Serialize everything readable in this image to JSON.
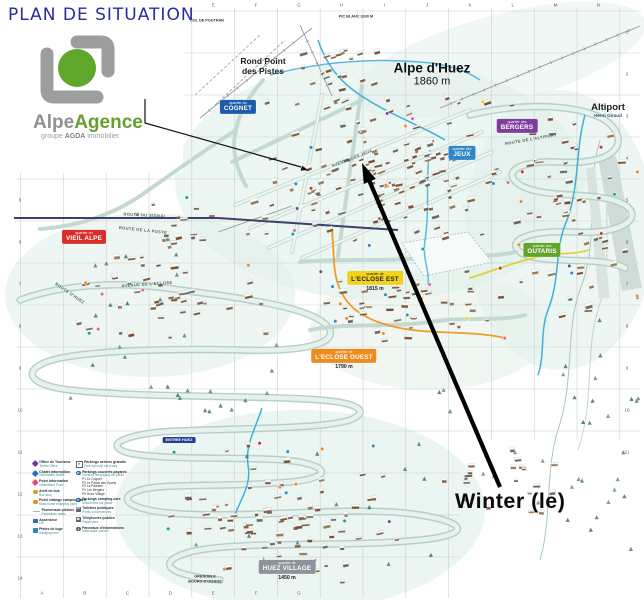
{
  "page": {
    "title": "PLAN DE SITUATION"
  },
  "logo": {
    "brand_gray": "Alpe",
    "brand_green": "Agence",
    "tagline_pre": "groupe",
    "tagline_bold": "AGDA",
    "tagline_post": "immobilier",
    "colors": {
      "mark_gray": "#9c9e9d",
      "mark_green": "#5fa62b"
    }
  },
  "annotation": {
    "label": "Winter (le)",
    "color": "#000000"
  },
  "resort": {
    "name": "Alpe d'Huez",
    "altitude": "1860 m"
  },
  "map": {
    "towns": [
      {
        "id": "rond-point",
        "lines": [
          "Rond Point",
          "des Pistes"
        ]
      },
      {
        "id": "altiport",
        "lines": [
          "Altiport",
          "Henri Giraud"
        ]
      },
      {
        "id": "col-de-poutran",
        "lines": [
          "COL DE POUTRAN"
        ]
      },
      {
        "id": "pic-blanc",
        "lines": [
          "PIC BLANC 3330 M"
        ]
      },
      {
        "id": "entree-huez",
        "lines": [
          "ENTREE HUEZ"
        ]
      },
      {
        "id": "grenoble",
        "lines": [
          "GRENOBLE",
          "BOURG D'OISANS"
        ]
      }
    ],
    "quartiers": [
      {
        "id": "cognet",
        "prefix": "quartier du",
        "name": "COGNET",
        "bg": "#1d5caa",
        "fg": "#ffffff"
      },
      {
        "id": "bergers",
        "prefix": "quartier des",
        "name": "BERGERS",
        "bg": "#7c3f9d",
        "fg": "#ffffff"
      },
      {
        "id": "jeux",
        "prefix": "quartier des",
        "name": "JEUX",
        "bg": "#2f86c8",
        "fg": "#ffffff"
      },
      {
        "id": "outaris",
        "prefix": "quartier des",
        "name": "OUTARIS",
        "bg": "#63a32e",
        "fg": "#ffffff"
      },
      {
        "id": "vieil-alpe",
        "prefix": "quartier du",
        "name": "VIEIL ALPE",
        "bg": "#d62f2a",
        "fg": "#ffffff"
      },
      {
        "id": "eclose-est",
        "prefix": "quartier de",
        "name": "L'ECLOSE EST",
        "bg": "#f2d21c",
        "fg": "#222222",
        "sub": "1815 m"
      },
      {
        "id": "eclose-ouest",
        "prefix": "quartier de",
        "name": "L'ECLOSE OUEST",
        "bg": "#ef8b1d",
        "fg": "#ffffff",
        "sub": "1790 m"
      },
      {
        "id": "huez-village",
        "prefix": "quartier de",
        "name": "HUEZ VILLAGE",
        "bg": "#8a949b",
        "fg": "#ffffff",
        "sub": "1450 m"
      }
    ],
    "streets": [
      "ROUTE DU SIGNAL",
      "ROUTE DE LA POSTE",
      "AVENUE DE L'ECLOSE",
      "ROUTE D'HUEZ",
      "AVENUE DES JEUX",
      "ROUTE DE L'ALTIPORT"
    ],
    "grid": {
      "columns": [
        "A",
        "B",
        "C",
        "D",
        "E",
        "F",
        "G",
        "H",
        "I",
        "J",
        "K",
        "L",
        "M",
        "N"
      ],
      "rows": [
        "1",
        "2",
        "3",
        "4",
        "5",
        "6",
        "7",
        "8",
        "9",
        "10",
        "11",
        "12",
        "13",
        "14"
      ]
    }
  },
  "legend": {
    "left": [
      {
        "fr": "Office de Tourisme",
        "en": "Tourist Office",
        "icon": "diamond",
        "color": "#6b3f9b"
      },
      {
        "fr": "Chalet information",
        "en": "Information chalet",
        "icon": "diamond",
        "color": "#2f6fb5"
      },
      {
        "fr": "Point Information",
        "en": "Information Point",
        "icon": "diamond",
        "color": "#e0487e"
      },
      {
        "fr": "Arrêt de bus",
        "en": "Bus stop",
        "icon": "circle",
        "color": "#d9a11c"
      },
      {
        "fr": "Point vidange camping-cars",
        "en": "Motorhome emptying point",
        "icon": "circle",
        "color": "#ef8b1d"
      },
      {
        "fr": "Promenade piétons",
        "en": "Pedestrian walks",
        "icon": "line",
        "color": "#7fc4b2"
      },
      {
        "fr": "Ascenseur",
        "en": "Lift",
        "icon": "square",
        "color": "#2f6fb5"
      },
      {
        "fr": "Pistes de luge",
        "en": "Sledging runs",
        "icon": "square",
        "color": "#2f86c8"
      }
    ],
    "right": [
      {
        "fr": "Parkings aériens gratuits",
        "en": "Free open-air car parks",
        "icon": "p-open",
        "color": "#5b6770"
      },
      {
        "fr": "Parkings couverts payants",
        "en": "Covered fee-paying car parks",
        "icon": "p-covered",
        "color": "#2f6fb5",
        "list": [
          "P1 Le Cognet",
          "P2 Le Palais des Sports",
          "P3 La Palestre",
          "P4 Les Bergers",
          "P5 Huez Village"
        ]
      },
      {
        "fr": "Parkings camping-cars",
        "en": "Motorhome car parks",
        "icon": "p-covered",
        "color": "#1d5caa"
      },
      {
        "fr": "Toilettes publiques",
        "en": "Public conveniences",
        "icon": "wc",
        "color": "#5b6770"
      },
      {
        "fr": "Téléphones publics",
        "en": "Payphones",
        "icon": "phone",
        "color": "#5b6770"
      },
      {
        "fr": "Panneaux d'informations",
        "en": "Information panels",
        "icon": "info",
        "color": "#5b6770"
      }
    ]
  }
}
